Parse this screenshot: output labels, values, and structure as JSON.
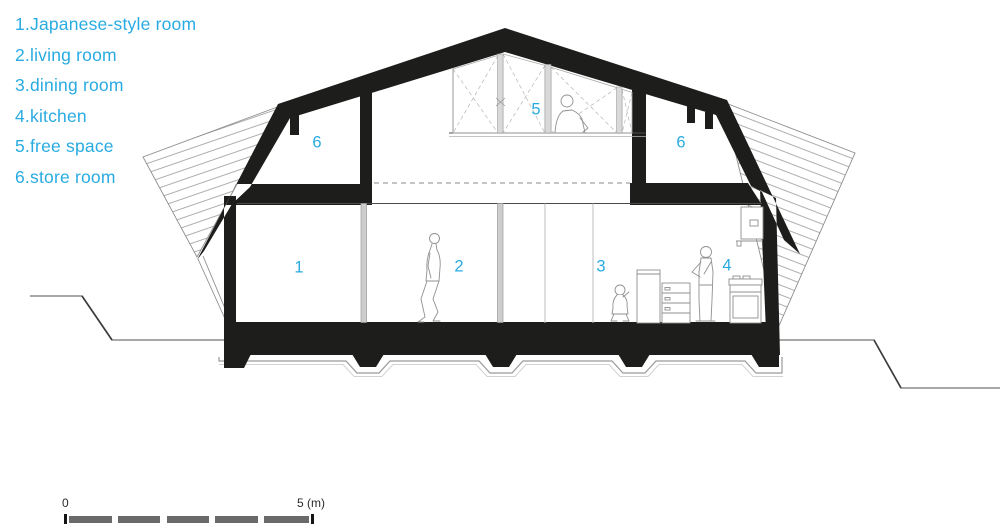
{
  "legend": {
    "items": [
      "1.Japanese-style room",
      "2.living room",
      "3.dining room",
      "4.kitchen",
      "5.free space",
      "6.store room"
    ]
  },
  "rooms": {
    "labels": [
      "1",
      "2",
      "3",
      "4",
      "5",
      "6",
      "6"
    ]
  },
  "scale_bar": {
    "start": "0",
    "end": "5 (m)"
  },
  "colors": {
    "accent": "#29abe2",
    "ink": "#1d1d1b",
    "scale_segment": "#6a6a6a",
    "hatch_line": "#9a9a9a"
  }
}
